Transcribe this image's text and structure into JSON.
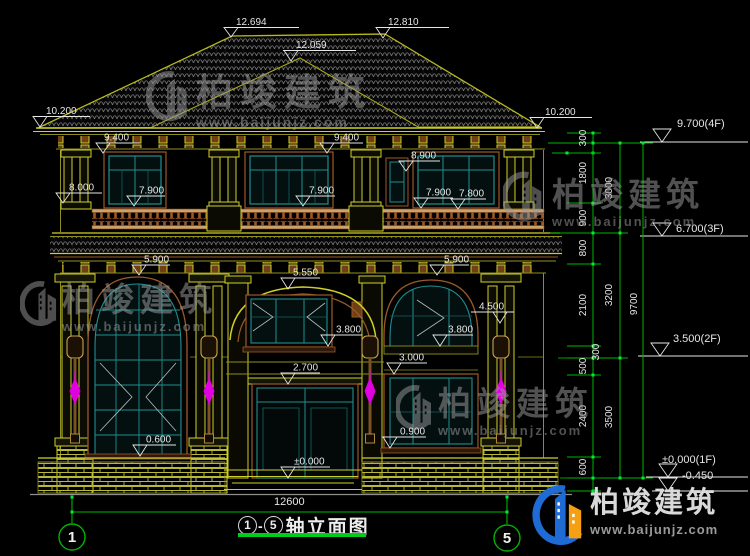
{
  "drawing": {
    "title": {
      "axis_from": "1",
      "axis_to": "5",
      "separator": "-",
      "text": "轴立面图"
    },
    "bottom_width_dim": "12600",
    "axis_bubbles": {
      "left": "1",
      "right": "5"
    }
  },
  "watermark": {
    "name": "柏竣建筑",
    "url": "www.baijunjz.com"
  },
  "brand_logo": {
    "name": "柏竣建筑",
    "url": "www.baijunjz.com"
  },
  "colors": {
    "dim_line": "#00b400",
    "bright": "#00e83a",
    "text": "#e6e6e6",
    "yellow": "#cfcf28",
    "teal": "#1f8f8f",
    "brown": "#9a5a28",
    "magenta": "#e000e0"
  },
  "dims": [
    {
      "t": "12.694",
      "x": 236,
      "y": 25,
      "l": [
        224,
        299,
        27.5
      ],
      "a": [
        231,
        37
      ]
    },
    {
      "t": "12.810",
      "x": 388,
      "y": 25,
      "l": [
        377,
        449,
        27.5
      ],
      "a": [
        383,
        38
      ]
    },
    {
      "t": "12.059",
      "x": 296,
      "y": 48,
      "l": [
        283,
        356,
        50.5
      ],
      "a": [
        291,
        61
      ]
    },
    {
      "t": "10.200",
      "x": 46,
      "y": 114,
      "l": [
        33,
        90,
        116.5
      ],
      "a": [
        40,
        127
      ]
    },
    {
      "t": "10.200",
      "x": 545,
      "y": 115,
      "l": [
        530,
        592,
        117.5
      ],
      "a": [
        537,
        128
      ]
    },
    {
      "t": "9.400",
      "x": 104,
      "y": 140.5,
      "l": [
        96,
        140,
        143
      ],
      "a": [
        103,
        153
      ]
    },
    {
      "t": "9.400",
      "x": 334,
      "y": 140.5,
      "l": [
        320,
        363,
        143
      ],
      "a": [
        327,
        153
      ]
    },
    {
      "t": "8.900",
      "x": 411,
      "y": 158.5,
      "l": [
        399,
        440,
        161
      ],
      "a": [
        406,
        171
      ]
    },
    {
      "t": "8.000",
      "x": 69,
      "y": 190.5,
      "l": [
        56,
        102,
        193
      ],
      "a": [
        63,
        203
      ]
    },
    {
      "t": "7.900",
      "x": 139,
      "y": 193.5,
      "l": [
        127,
        165,
        196
      ],
      "a": [
        134,
        206
      ]
    },
    {
      "t": "7.900",
      "x": 309,
      "y": 193.5,
      "l": [
        297,
        335,
        196
      ],
      "a": [
        303,
        206
      ]
    },
    {
      "t": "7.900",
      "x": 426,
      "y": 195.5,
      "l": [
        414,
        453,
        198
      ],
      "a": [
        421,
        208
      ]
    },
    {
      "t": "7.800",
      "x": 459,
      "y": 196.5,
      "l": [
        451,
        486,
        199
      ],
      "a": [
        458,
        209
      ]
    },
    {
      "t": "5.900",
      "x": 144,
      "y": 262.5,
      "l": [
        132,
        170,
        265
      ],
      "a": [
        139,
        275
      ]
    },
    {
      "t": "5.550",
      "x": 293,
      "y": 275.5,
      "l": [
        281,
        320,
        278
      ],
      "a": [
        288,
        289
      ]
    },
    {
      "t": "5.900",
      "x": 444,
      "y": 262.5,
      "l": [
        430,
        469,
        265
      ],
      "a": [
        437,
        275
      ]
    },
    {
      "t": "4.500",
      "x": 479,
      "y": 309.5,
      "l": [
        471,
        514,
        312
      ],
      "a": [
        500,
        323
      ]
    },
    {
      "t": "3.800",
      "x": 336,
      "y": 332.5,
      "l": [
        322,
        362,
        335
      ],
      "a": [
        328,
        346
      ]
    },
    {
      "t": "3.800",
      "x": 448,
      "y": 332.5,
      "l": [
        434,
        473,
        335
      ],
      "a": [
        440,
        346
      ]
    },
    {
      "t": "3.000",
      "x": 399,
      "y": 360.5,
      "l": [
        388,
        427,
        363
      ],
      "a": [
        394,
        374
      ]
    },
    {
      "t": "2.700",
      "x": 293,
      "y": 370.5,
      "l": [
        281,
        320,
        373
      ],
      "a": [
        288,
        384
      ]
    },
    {
      "t": "0.600",
      "x": 146,
      "y": 442.5,
      "l": [
        133,
        176,
        445
      ],
      "a": [
        140,
        456
      ]
    },
    {
      "t": "0.900",
      "x": 400,
      "y": 434.5,
      "l": [
        382,
        426,
        437
      ],
      "a": [
        390,
        448
      ]
    },
    {
      "t": "±0.000",
      "x": 294,
      "y": 464.5,
      "l": [
        281,
        330,
        467
      ],
      "a": [
        288,
        478
      ]
    }
  ],
  "floor_marks": [
    {
      "t": "9.700(4F)",
      "x": 677,
      "y": 127,
      "ax": 662,
      "ly": 142,
      "lx1": 640,
      "lx2": 748
    },
    {
      "t": "6.700(3F)",
      "x": 676,
      "y": 232,
      "ax": 662,
      "ly": 236,
      "lx1": 640,
      "lx2": 748
    },
    {
      "t": "3.500(2F)",
      "x": 673,
      "y": 342,
      "ax": 660,
      "ly": 356,
      "lx1": 638,
      "lx2": 748
    },
    {
      "t": "±0.000(1F)",
      "x": 662,
      "y": 463,
      "ax": 668,
      "ly": 477,
      "lx1": 646,
      "lx2": 748
    },
    {
      "t": "-0.450",
      "x": 682,
      "y": 479,
      "ax": 668,
      "ly": 491,
      "lx1": 652,
      "lx2": 748
    }
  ],
  "chain": {
    "x1": 593,
    "x2": 620,
    "x3": 643,
    "rows": [
      {
        "t": "300",
        "c": 138
      },
      {
        "t": "1800",
        "c": 173
      },
      {
        "t": "900",
        "c": 218
      },
      {
        "t": "800",
        "c": 248
      },
      {
        "t": "2100",
        "c": 305
      },
      {
        "t": "300",
        "c": 352,
        "x": 599
      },
      {
        "t": "500",
        "c": 366
      },
      {
        "t": "2400",
        "c": 416
      },
      {
        "t": "600",
        "c": 467
      }
    ],
    "sub": [
      {
        "t": "3000",
        "c": 188
      },
      {
        "t": "3200",
        "c": 295
      },
      {
        "t": "3500",
        "c": 417
      }
    ],
    "total": {
      "t": "9700",
      "c": 304
    },
    "b1": [
      133,
      143,
      203,
      233,
      264,
      346,
      358,
      375,
      457,
      478,
      491
    ],
    "b2": [
      143,
      233,
      358,
      478
    ],
    "b3": [
      143,
      478
    ]
  }
}
